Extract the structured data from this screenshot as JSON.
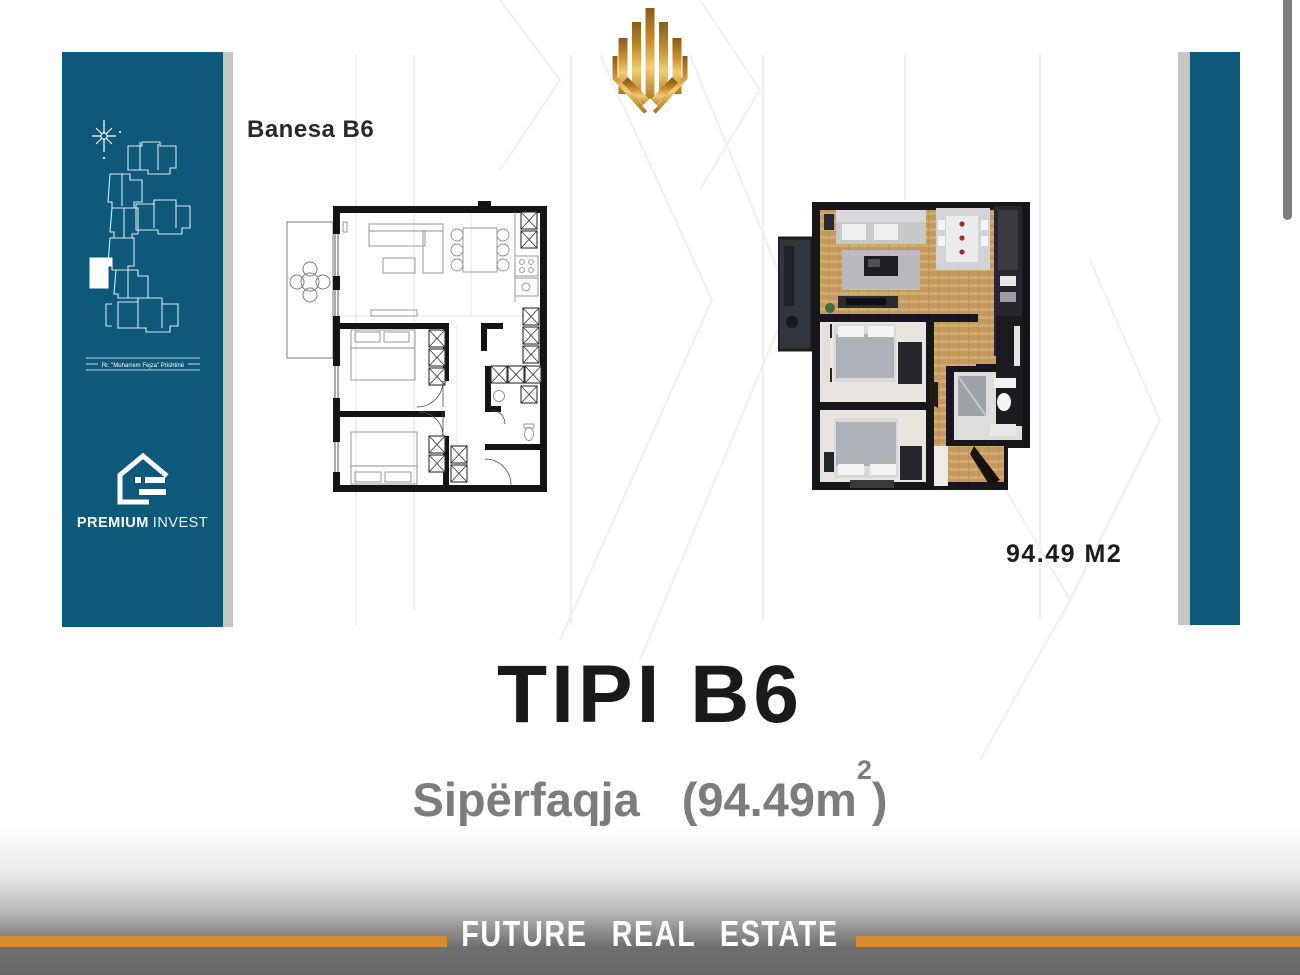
{
  "page": {
    "background": "#ffffff"
  },
  "colors": {
    "teal": "#0e587a",
    "accent_orange": "#d68d32",
    "gold": "#c9962e",
    "footer_gray": "#6f6f6f"
  },
  "sidebar": {
    "address_line": "Rr. \"Muharrem Fejza\" Prishtinë",
    "brand_bold": "PREMIUM",
    "brand_light": "INVEST"
  },
  "plans": {
    "plan_label": "Banesa B6",
    "area_note": "94.49 M2"
  },
  "summary": {
    "title": "TIPI B6",
    "subtitle_label": "Sipërfaqja",
    "subtitle_open": "(94.49m",
    "subtitle_sup": "2",
    "subtitle_close": ")"
  },
  "footer": {
    "text": "FUTURE REAL ESTATE"
  }
}
